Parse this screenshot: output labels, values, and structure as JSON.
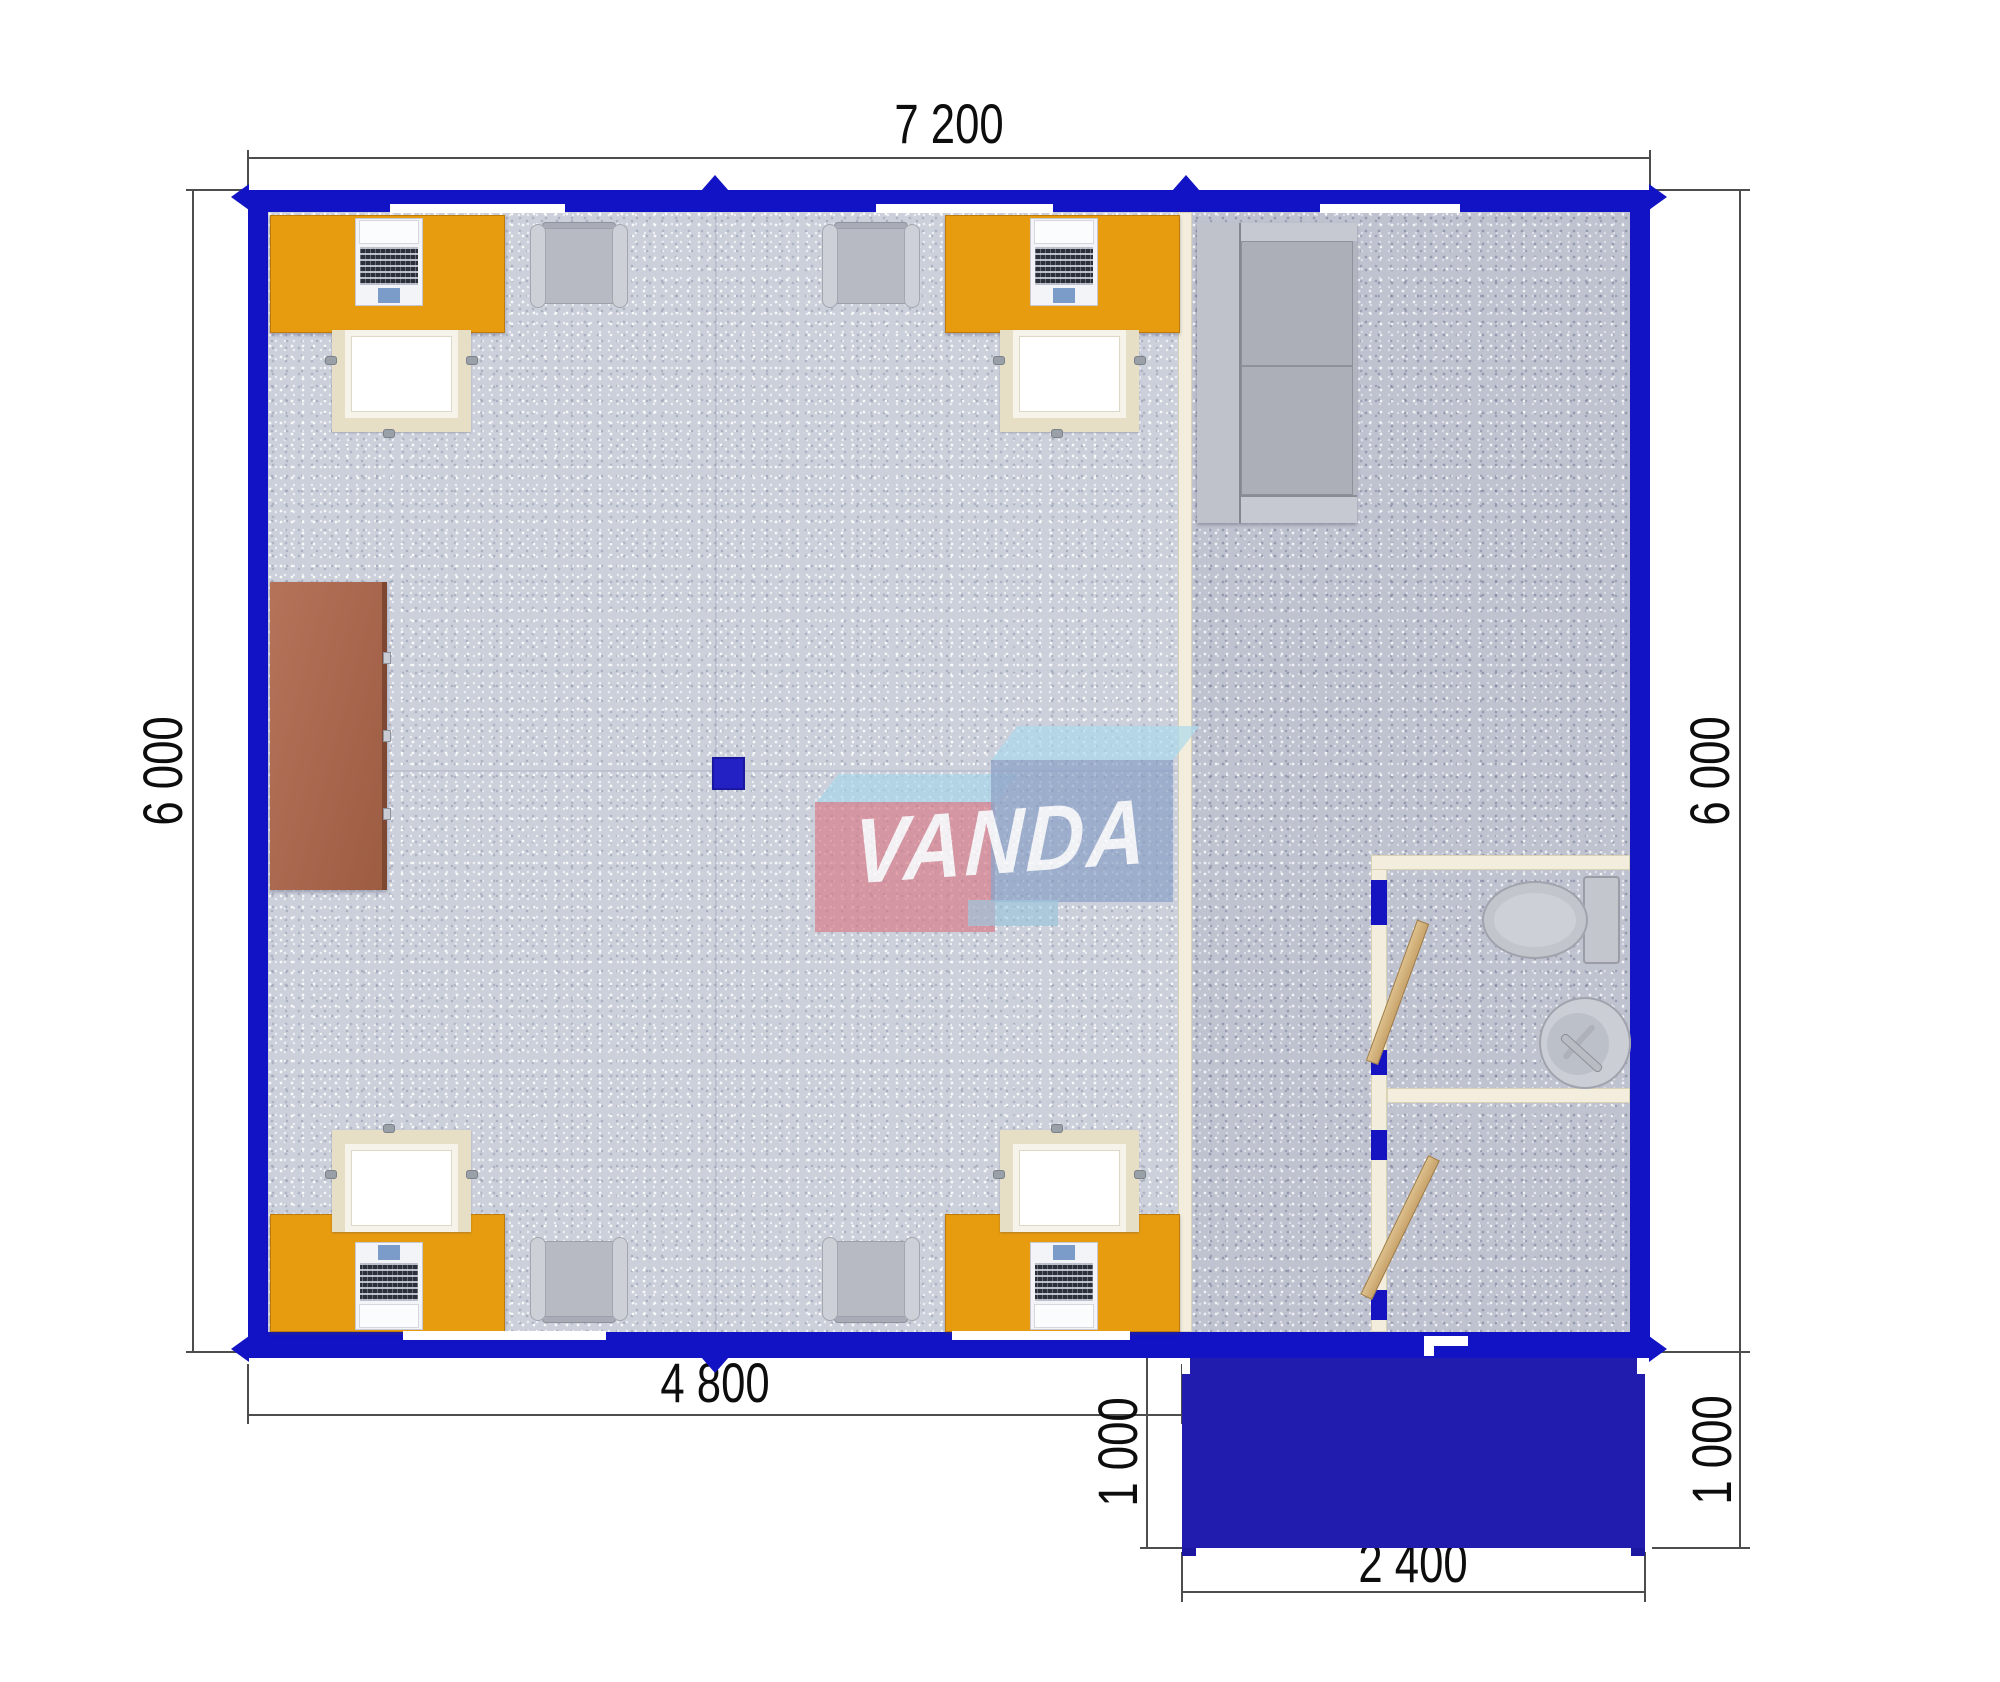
{
  "plan": {
    "title": "Modular office floor plan",
    "brand_logo": {
      "text": "VANDA"
    },
    "dimensions": {
      "top_width_mm": "7 200",
      "left_height_mm": "6 000",
      "right_height_mm": "6 000",
      "bottom_width_mm": "4 800",
      "porch_height_left_mm": "1 000",
      "porch_height_right_mm": "1 000",
      "porch_width_mm": "2 400"
    },
    "colors": {
      "wall_blue": "#1213c4",
      "porch_blue": "#221cae",
      "desk_orange": "#e79c0f",
      "cabinet_brown": "#a86a4e",
      "partition_cream": "#f2eddc",
      "floor_main": "#ccd0db",
      "floor_right": "#bfc2cf",
      "logo_pink": "#d67d89",
      "logo_steel_blue": "#869ec6",
      "logo_light_blue": "#a8d6ea"
    },
    "furniture_icons": [
      "desk",
      "laptop",
      "office-chair",
      "armchair",
      "sofa",
      "cabinet",
      "toilet",
      "sink",
      "door-leaf",
      "ceiling-lamp"
    ]
  }
}
